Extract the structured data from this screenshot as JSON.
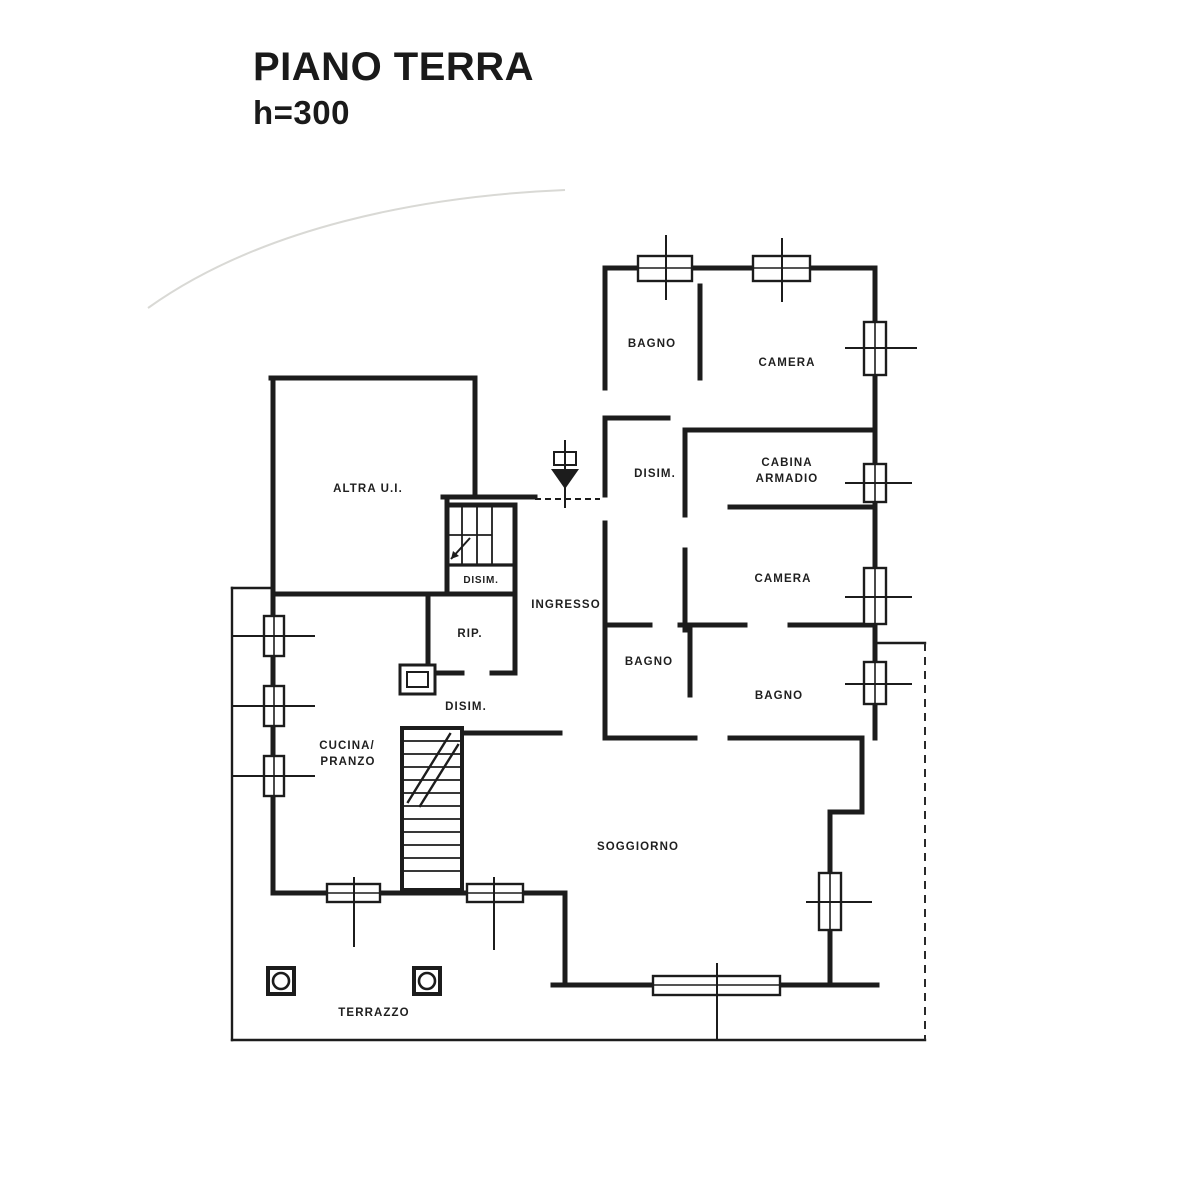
{
  "title": {
    "floor": "PIANO TERRA",
    "height": "h=300"
  },
  "rooms": {
    "bagno_nord": {
      "label": "BAGNO"
    },
    "camera_nord": {
      "label": "CAMERA"
    },
    "disimpegno_notte": {
      "label": "DISIM."
    },
    "cabina_armadio": {
      "line1": "CABINA",
      "line2": "ARMADIO"
    },
    "camera_est": {
      "label": "CAMERA"
    },
    "bagno_centro": {
      "label": "BAGNO"
    },
    "bagno_est": {
      "label": "BAGNO"
    },
    "altra_ui": {
      "label": "ALTRA U.I."
    },
    "disimpegno_ingresso": {
      "label": "DISIM."
    },
    "ingresso": {
      "label": "INGRESSO"
    },
    "ripostiglio": {
      "label": "RIP."
    },
    "disimpegno_giorno": {
      "label": "DISIM."
    },
    "cucina_pranzo": {
      "line1": "CUCINA/",
      "line2": "PRANZO"
    },
    "soggiorno": {
      "label": "SOGGIORNO"
    },
    "terrazzo": {
      "label": "TERRAZZO"
    }
  },
  "colors": {
    "ink": "#1c1c1c",
    "paper": "#ffffff"
  }
}
